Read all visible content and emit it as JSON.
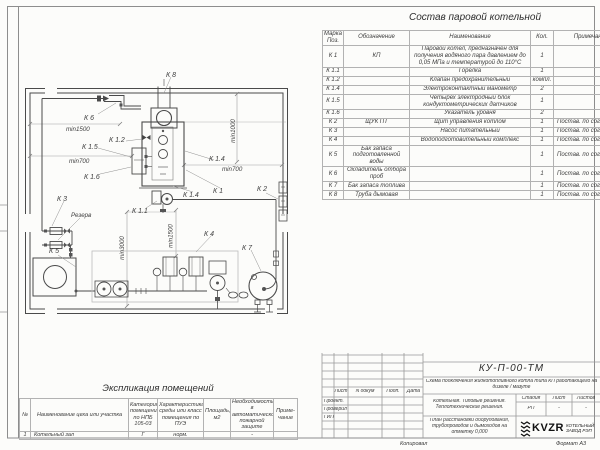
{
  "composition": {
    "title": "Состав паровой котельной",
    "headers": {
      "mark": "Марка Поз.",
      "code": "Обозначение",
      "name": "Наименование",
      "qty": "Кол.",
      "note": "Примечание"
    },
    "rows": [
      {
        "mark": "К 1",
        "code": "КП",
        "name": "Паровой котел, предназначен для получения водяного пара давлением до 0,05 МПа и температурой до 110°С",
        "qty": "1",
        "note": ""
      },
      {
        "mark": "К 1.1",
        "code": "",
        "name": "Горелка",
        "qty": "1",
        "note": ""
      },
      {
        "mark": "К 1.2",
        "code": "",
        "name": "Клапан предохранительный",
        "qty": "компл.",
        "note": ""
      },
      {
        "mark": "К 1.4",
        "code": "",
        "name": "Электроконтактный манометр",
        "qty": "2",
        "note": ""
      },
      {
        "mark": "К 1.5",
        "code": "",
        "name": "Четырех электродный блок кондуктометрических датчиков",
        "qty": "1",
        "note": ""
      },
      {
        "mark": "К 1.6",
        "code": "",
        "name": "Указатель уровня",
        "qty": "2",
        "note": ""
      },
      {
        "mark": "К 2",
        "code": "ЩУК ПТ",
        "name": "Щит управления котлом",
        "qty": "1",
        "note": "Постав. по согласов."
      },
      {
        "mark": "К 3",
        "code": "",
        "name": "Насос питательный",
        "qty": "1",
        "note": "Постав. по согласов."
      },
      {
        "mark": "К 4",
        "code": "",
        "name": "Водоподготовительный комплекс",
        "qty": "1",
        "note": "Постав. по согласов."
      },
      {
        "mark": "К 5",
        "code": "Бак запаса подготовленной воды",
        "name": "",
        "qty": "1",
        "note": "Постав. по согласов."
      },
      {
        "mark": "К 6",
        "code": "Охладитель отбора проб",
        "name": "",
        "qty": "1",
        "note": "Постав. по согласов."
      },
      {
        "mark": "К 7",
        "code": "Бак запаса топлива",
        "name": "",
        "qty": "1",
        "note": "Постав. по согласов."
      },
      {
        "mark": "К 8",
        "code": "Труба дымовая",
        "name": "",
        "qty": "1",
        "note": "Постав. по согласов."
      }
    ]
  },
  "drawing": {
    "labels": {
      "k8": "К 8",
      "k6": "К 6",
      "min1500_a": "min1500",
      "k12": "К 1.2",
      "k15": "К 1.5",
      "min700_l": "min700",
      "k16": "К 1.6",
      "k14_a": "К 1.4",
      "min1000": "min1000",
      "min700_r": "min700",
      "k2": "К 2",
      "k1": "К 1",
      "k14_b": "К 1.4",
      "k11": "К 1.1",
      "k3": "К 3",
      "rezerv": "Резерв",
      "k5": "К 5",
      "min3000": "min3000",
      "min1500_b": "min1500",
      "k4": "К 4",
      "k7": "К 7"
    }
  },
  "explication": {
    "title": "Экспликация помещений",
    "headers": [
      "№",
      "Наименование цеха или участка",
      "Категория помещения по НПБ 105-03",
      "Характеристика среды или класс помещения по ПУЭ",
      "Площадь, м2",
      "Необходимость в автоматической пожарной защите",
      "Приме- чание"
    ],
    "row": [
      "1",
      "Котельный зал",
      "Г",
      "норм.",
      "",
      "-",
      ""
    ]
  },
  "title_block": {
    "doc_code": "КУ-П-00-ТМ",
    "doc_name": "Схема подключения жидкотопливного котла типа КП работающего на дизеле / мазуте",
    "project_name": "Котельная. Типовые решения. Теплотехнические решения.",
    "sheet_name": "План расстановки оборудования, трубопроводов и дымоходов на отметку 0,000",
    "cols": {
      "sheet": "Лист",
      "doc": "N докум",
      "sign": "Подп.",
      "date": "Дата"
    },
    "roles": {
      "r1": "Проект.",
      "r2": "Проверил",
      "r3": "ГИП"
    },
    "stage_label": "Стадия",
    "stage_value": "РП",
    "sheet_label": "Лист",
    "sheet_value": "-",
    "sheets_label": "Листов",
    "sheets_value": "-",
    "company": {
      "logo": "KVZR",
      "name": "КОТЕЛЬНЫЙ ЗАВОД РЭП"
    }
  },
  "footer": {
    "copied": "Копировал",
    "format": "Формат А3"
  }
}
